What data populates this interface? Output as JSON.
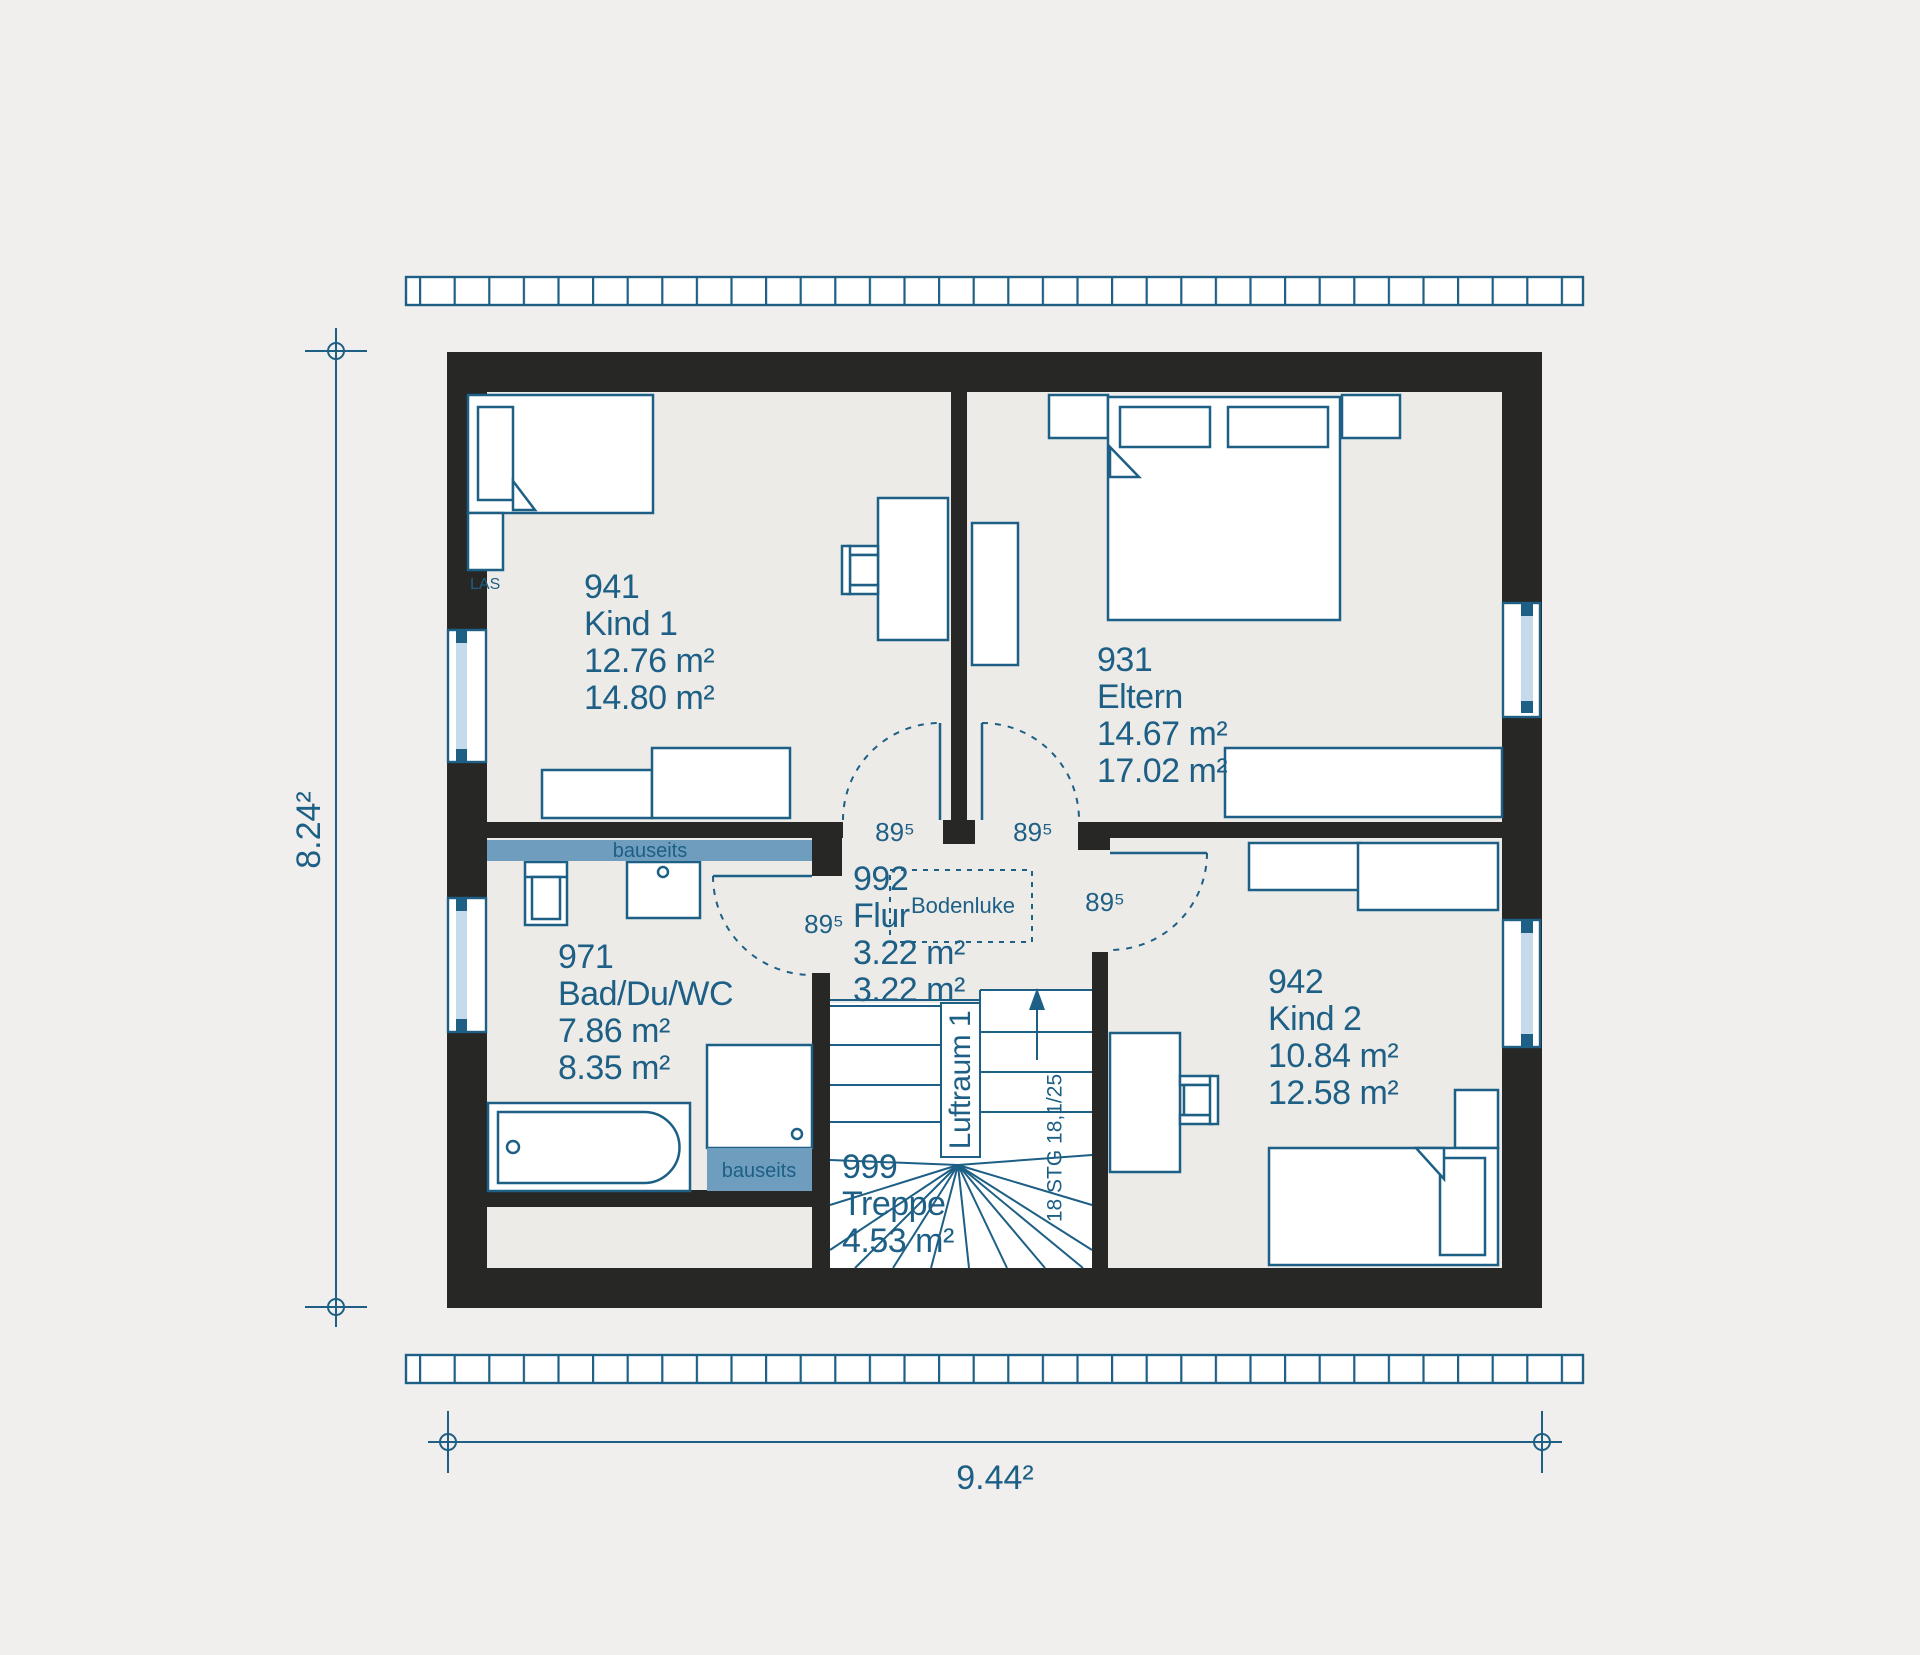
{
  "floorplan": {
    "rooms": [
      {
        "number": "941",
        "name": "Kind 1",
        "floor_area": "12.76 m²",
        "living_area": "14.80 m²"
      },
      {
        "number": "931",
        "name": "Eltern",
        "floor_area": "14.67 m²",
        "living_area": "17.02 m²"
      },
      {
        "number": "942",
        "name": "Kind 2",
        "floor_area": "10.84 m²",
        "living_area": "12.58 m²"
      },
      {
        "number": "971",
        "name": "Bad/Du/WC",
        "floor_area": "7.86 m²",
        "living_area": "8.35 m²"
      },
      {
        "number": "992",
        "name": "Flur",
        "floor_area": "3.22 m²",
        "living_area": "3.22 m²"
      },
      {
        "number": "999",
        "name": "Treppe",
        "floor_area": "4.53 m²"
      }
    ],
    "annotations": {
      "bodenluke": "Bodenluke",
      "luftraum": "Luftraum 1",
      "stair_note": "18 STG 18,1/25",
      "las": "LAS",
      "bauseits": "bauseits",
      "door_width": "89⁵"
    },
    "dimensions": {
      "overall_width": "9.44²",
      "overall_height": "8.24²"
    },
    "colors": {
      "wall": "#272726",
      "line_blue": "#1d5f85",
      "room_fill": "#ecebe8",
      "bauseits_fill": "#6f9dbe",
      "glazing": "#c5daea",
      "background": "#f0efee"
    }
  }
}
